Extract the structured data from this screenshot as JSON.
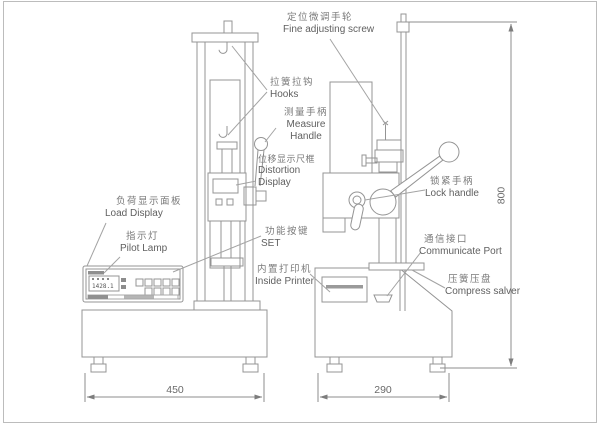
{
  "labels": {
    "fine_adjusting_screw": {
      "zh": "定位微调手轮",
      "en": "Fine adjusting screw"
    },
    "hooks": {
      "zh": "拉簧拉钩",
      "en": "Hooks"
    },
    "measure_handle": {
      "zh": "测量手柄",
      "en": "Measure Handle"
    },
    "distortion_display": {
      "zh": "位移显示尺框",
      "en": "Distortion Display"
    },
    "load_display": {
      "zh": "负荷显示面板",
      "en": "Load Display"
    },
    "pilot_lamp": {
      "zh": "指示灯",
      "en": "Pilot Lamp"
    },
    "set_keys": {
      "zh": "功能按键",
      "en": "SET"
    },
    "inside_printer": {
      "zh": "内置打印机",
      "en": "Inside Printer"
    },
    "lock_handle": {
      "zh": "锁紧手柄",
      "en": "Lock handle"
    },
    "communicate_port": {
      "zh": "通信接口",
      "en": "Communicate Port"
    },
    "compress_salver": {
      "zh": "压簧压盘",
      "en": "Compress salver"
    }
  },
  "dimensions": {
    "left_base_width": "450",
    "right_base_width": "290",
    "column_height": "800"
  },
  "panel": {
    "display_value": "1428.1"
  },
  "colors": {
    "line": "#949494",
    "text": "#6e6e6e",
    "background": "#ffffff"
  }
}
